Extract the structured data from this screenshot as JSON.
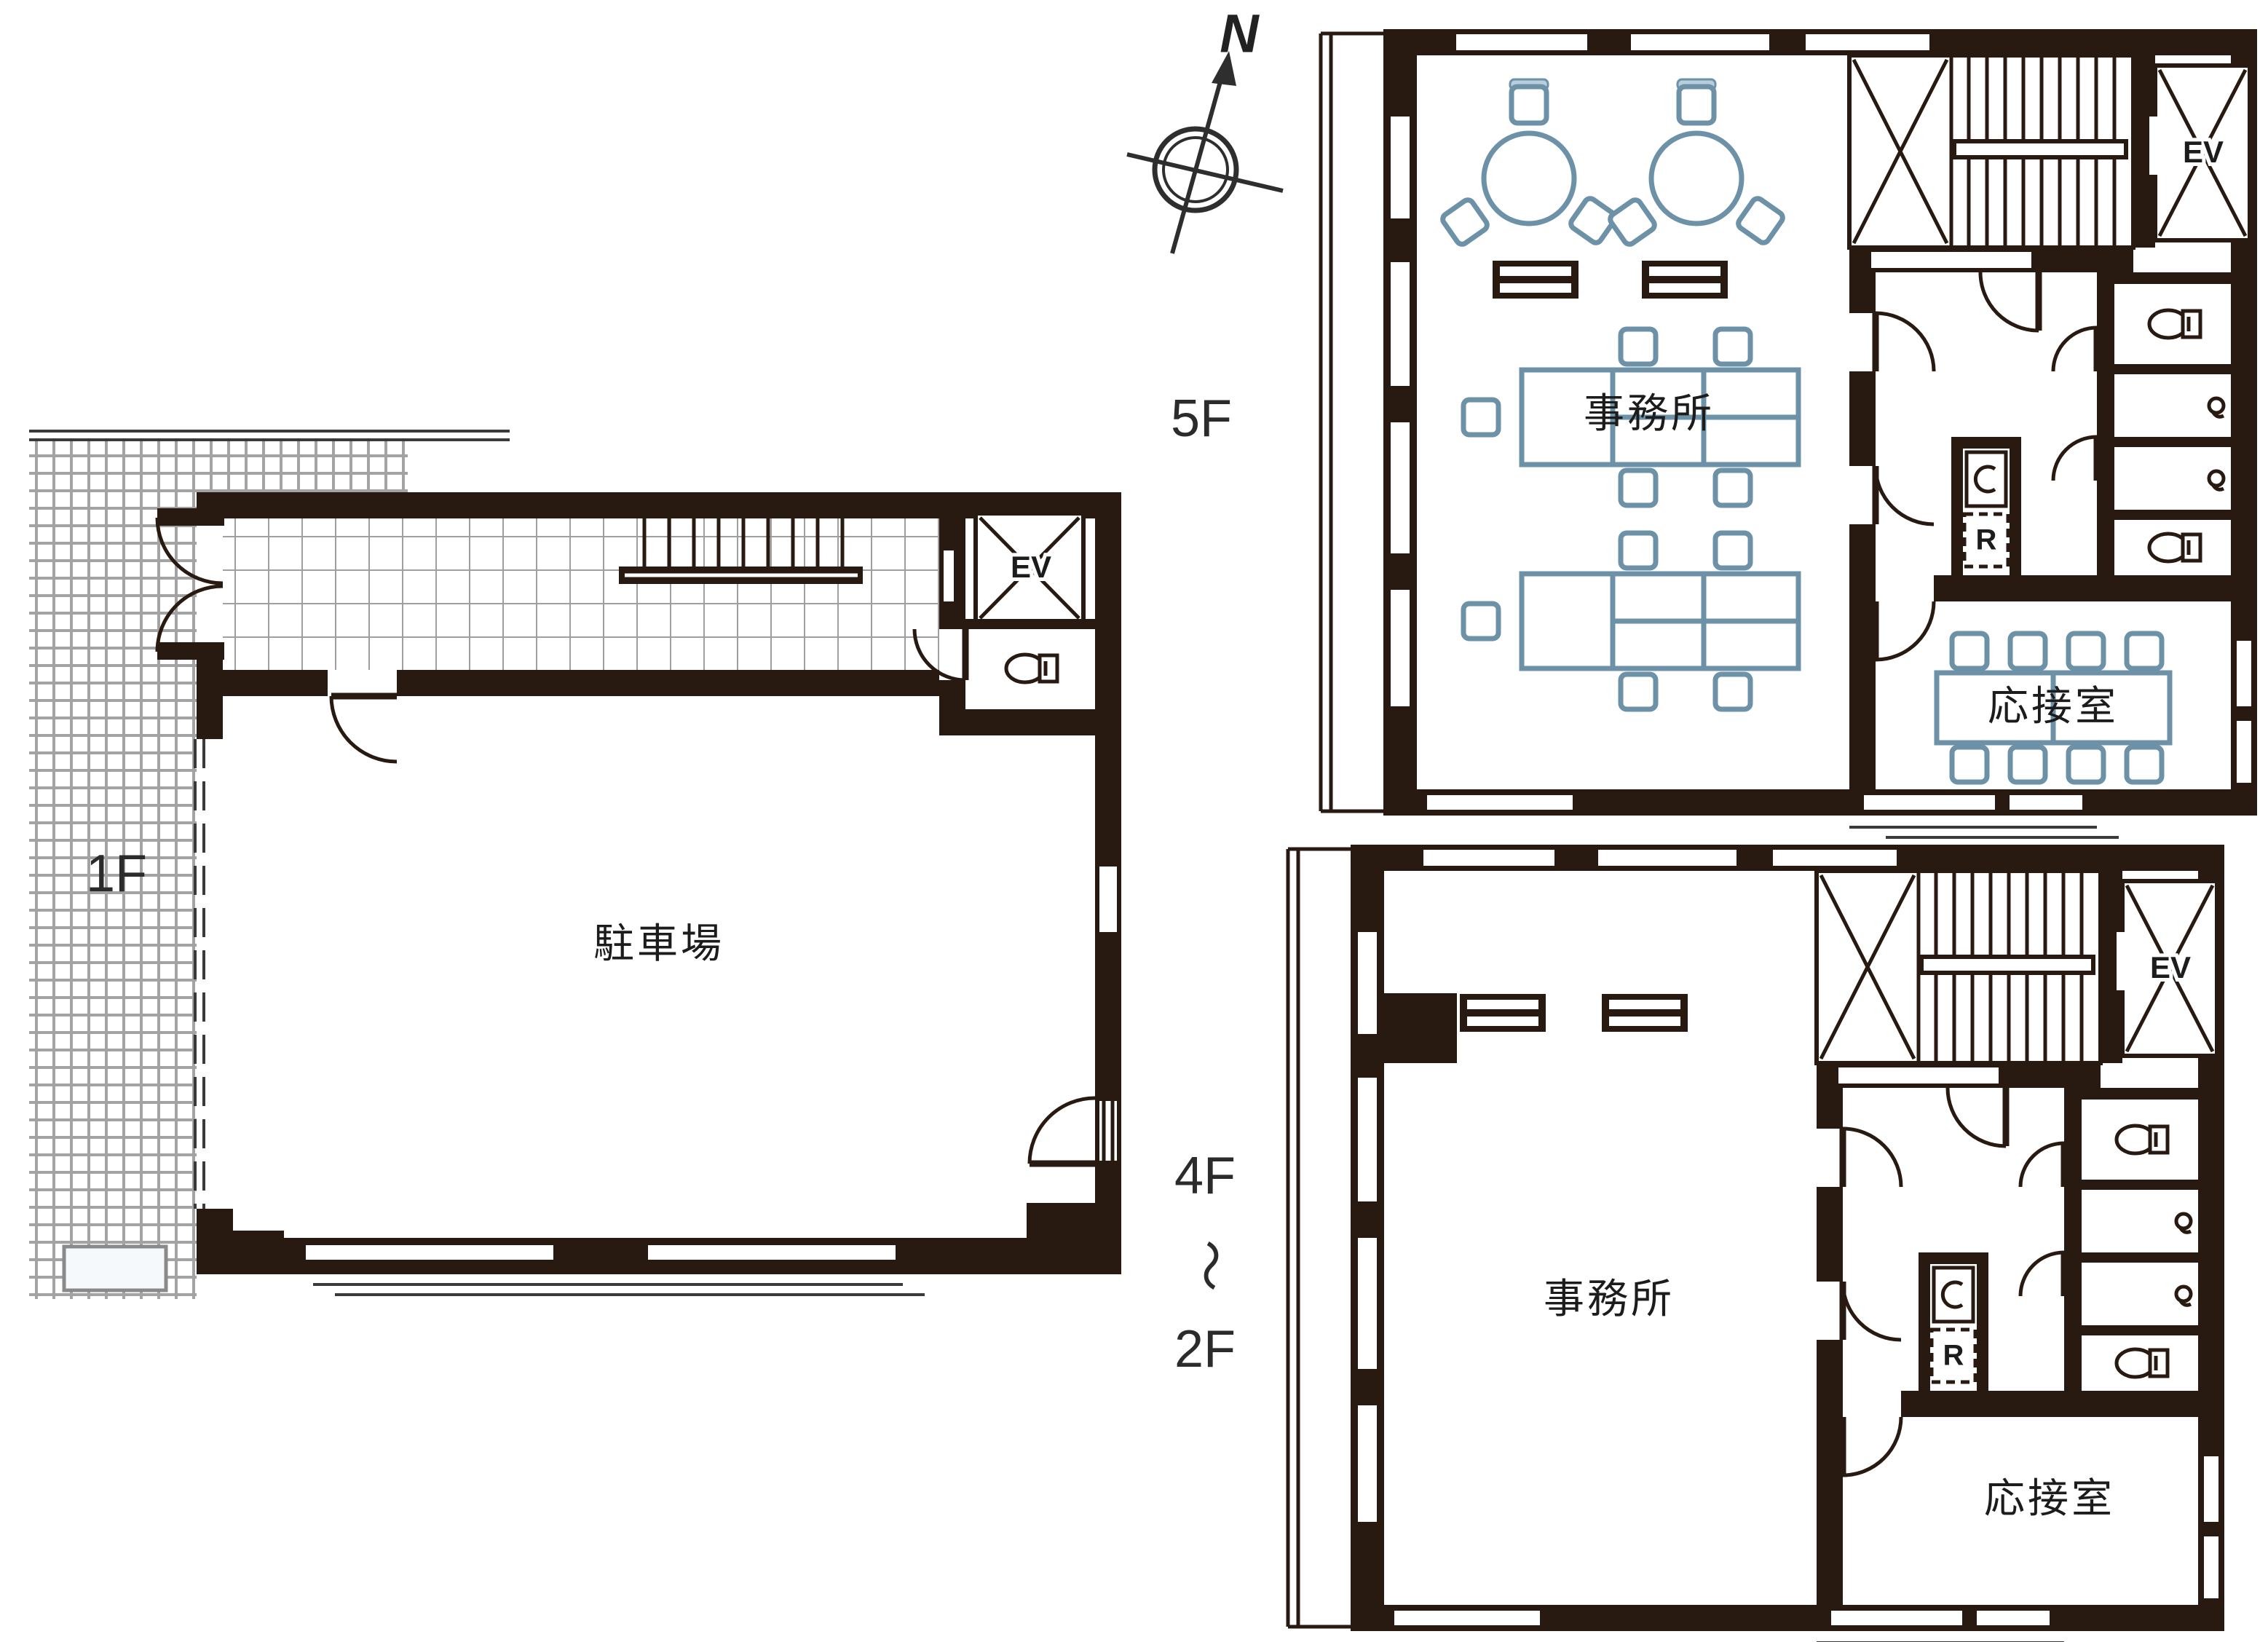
{
  "title": "建物フロアプラン図 (building floor plans)",
  "colors": {
    "wall": "#281a10",
    "furniture_outline": "#6d91a7",
    "furniture_shade": "#b9cedd",
    "tile_grid": "#a3a3a3",
    "background": "#ffffff"
  },
  "compass": {
    "label": "N"
  },
  "core": {
    "elevator": "EV",
    "refrigerator": "R"
  },
  "floor_1f": {
    "label": "1F",
    "rooms": {
      "parking": "駐車場"
    }
  },
  "floor_5f": {
    "label": "5F",
    "rooms": {
      "office": "事務所",
      "reception": "応接室"
    }
  },
  "floor_2_4f": {
    "label_top": "4F",
    "label_tilde": "～",
    "label_bottom": "2F",
    "rooms": {
      "office": "事務所",
      "reception": "応接室"
    }
  }
}
